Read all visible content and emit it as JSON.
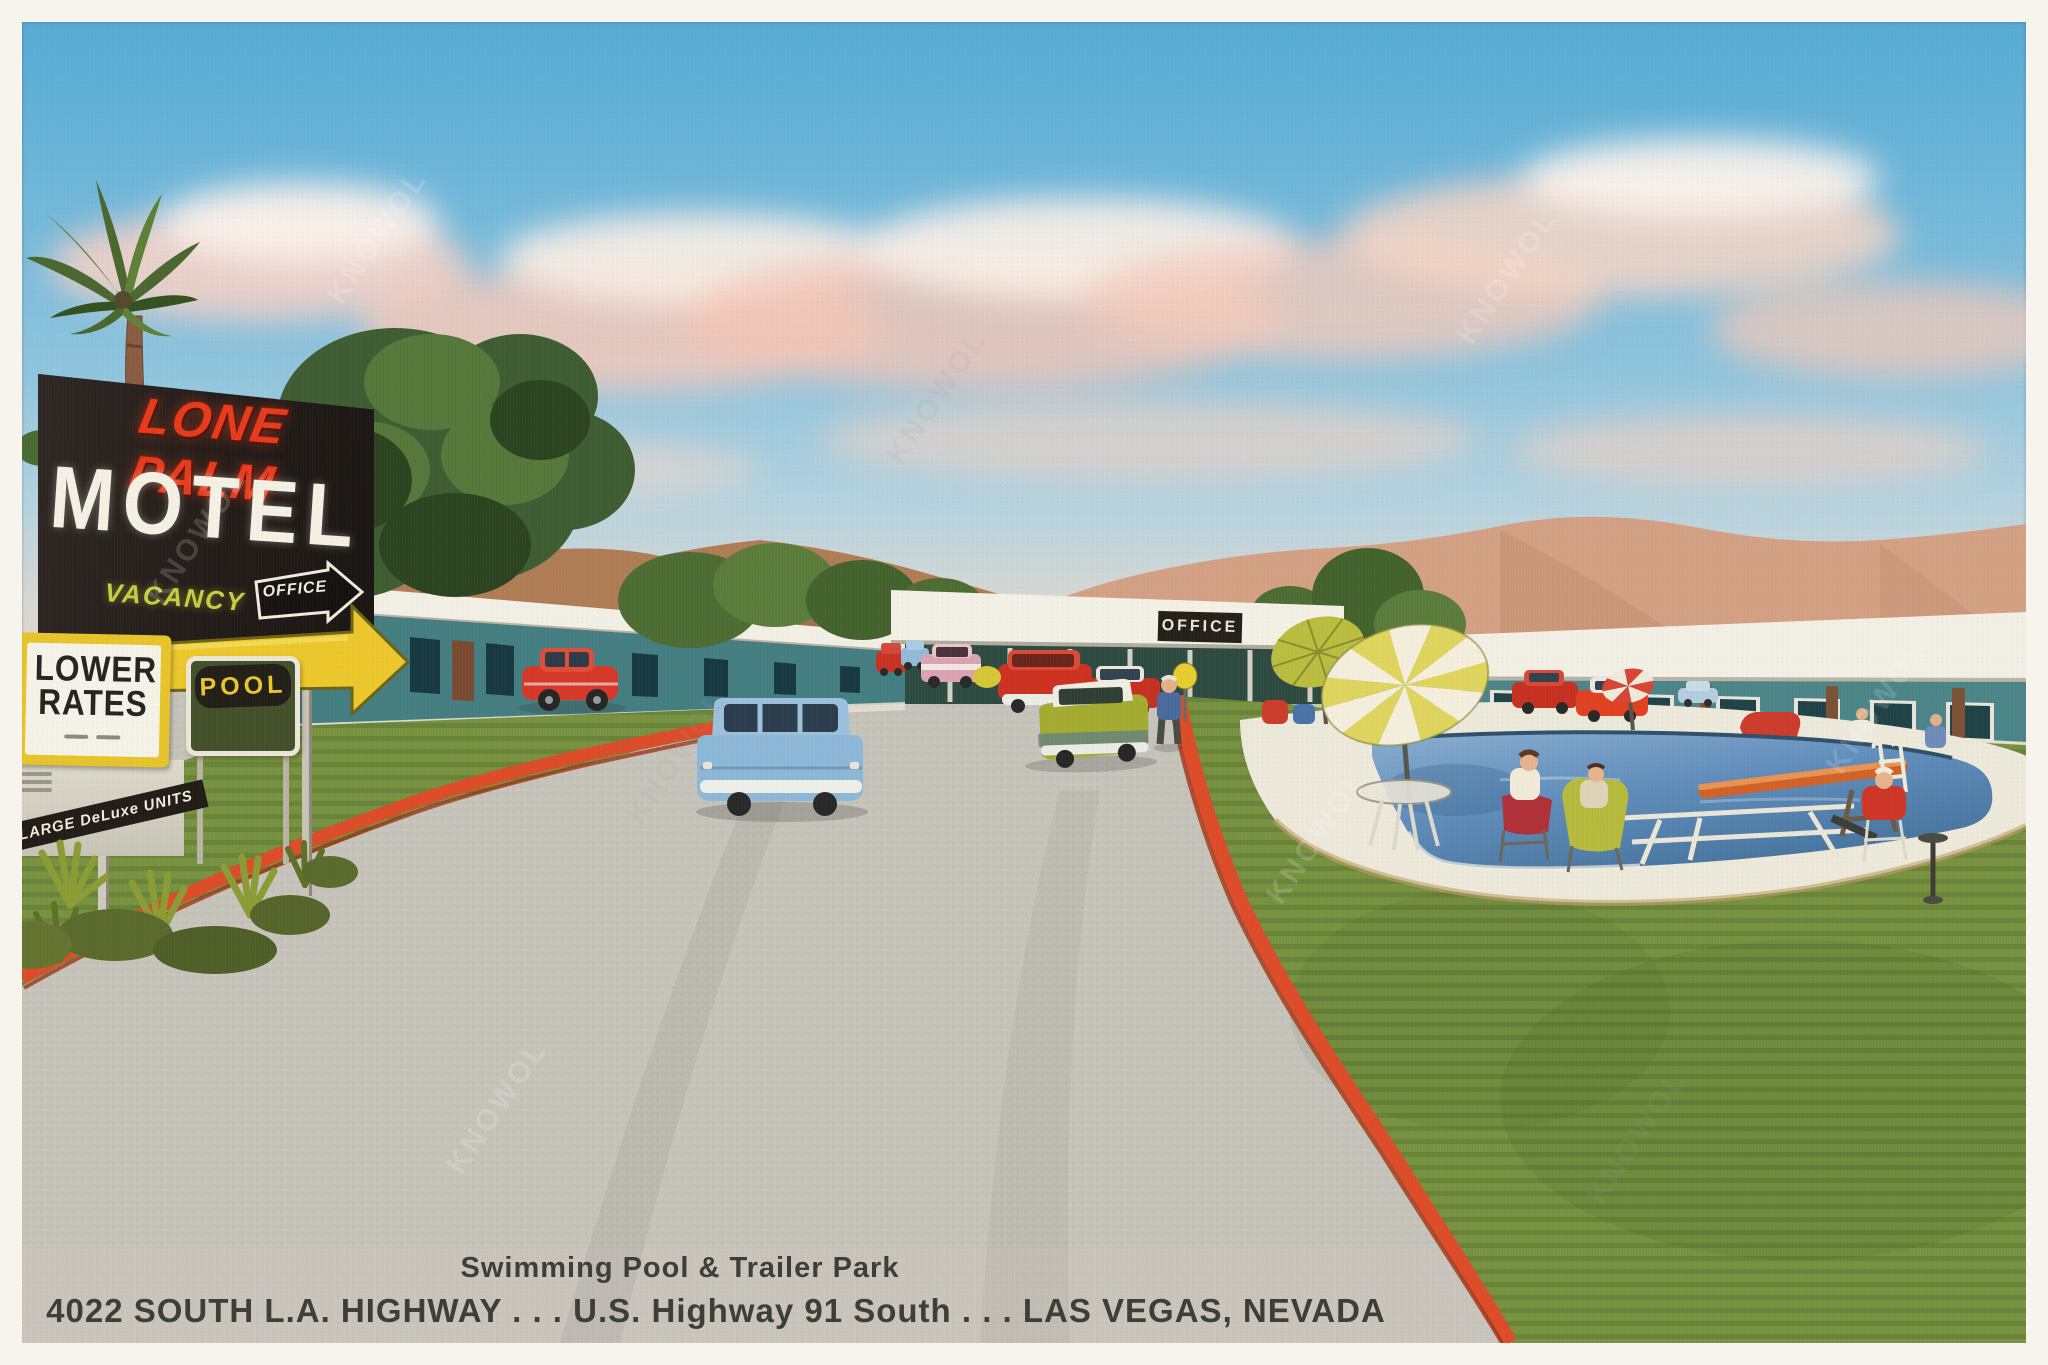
{
  "postcard": {
    "main_sign": {
      "name": "LONE PALM",
      "motel": "MOTEL",
      "vacancy": "VACANCY",
      "office_arrow": "OFFICE"
    },
    "rates_sign": {
      "line1": "LOWER",
      "line2": "RATES"
    },
    "pool_sign": {
      "label": "POOL"
    },
    "banner_sign": {
      "label": "LARGE DeLuxe UNITS"
    },
    "office_building_sign": {
      "label": "OFFICE"
    },
    "caption": {
      "line1": "Swimming Pool & Trailer Park",
      "line2": "4022 SOUTH L.A. HIGHWAY . . . U.S. Highway 91 South . . . LAS VEGAS, NEVADA"
    },
    "watermark": "KNOWOL",
    "palette": {
      "sky_blue": "#6fb5d8",
      "cloud_pink": "#f2c8bb",
      "mountain_brown": "#b07c54",
      "mountain_pink": "#d3a083",
      "building_teal": "#447e80",
      "roof_white": "#f2efe4",
      "grass_green": "#77923f",
      "curb_red": "#dd4c28",
      "pavement_gray": "#c6c3ba",
      "pool_blue": "#5f8cba",
      "sign_black": "#241f1b",
      "neon_red": "#e63a1d",
      "arrow_yellow": "#ecc72b"
    }
  }
}
